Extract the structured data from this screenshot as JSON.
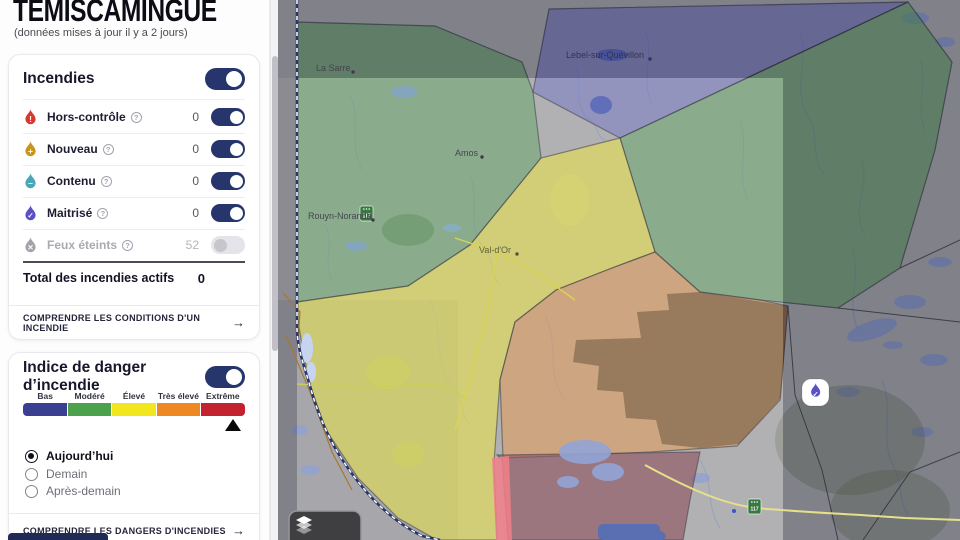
{
  "header": {
    "title": "TÉMISCAMINGUE",
    "subtitle": "(données mises à jour il y a 2 jours)"
  },
  "fires": {
    "section_title": "Incendies",
    "rows": [
      {
        "label": "Hors-contrôle",
        "count": "0",
        "color": "#d6392f",
        "symbol": "!",
        "toggle": "on"
      },
      {
        "label": "Nouveau",
        "count": "0",
        "color": "#c9941c",
        "symbol": "+",
        "toggle": "on"
      },
      {
        "label": "Contenu",
        "count": "0",
        "color": "#49a8b8",
        "symbol": "–",
        "toggle": "on"
      },
      {
        "label": "Maitrisé",
        "count": "0",
        "color": "#5b50c5",
        "symbol": "✓",
        "toggle": "on"
      },
      {
        "label": "Feux éteints",
        "count": "52",
        "color": "#a2a2a8",
        "symbol": "✕",
        "toggle": "off"
      }
    ],
    "info_icon": "?",
    "total_label": "Total des incendies actifs",
    "total_value": "0",
    "link": "COMPRENDRE LES CONDITIONS D'UN INCENDIE",
    "link_arrow": "→"
  },
  "danger": {
    "section_title": "Indice de danger d’incendie",
    "levels": [
      {
        "label": "Bas",
        "color": "#3b3f92"
      },
      {
        "label": "Modéré",
        "color": "#4ca24c"
      },
      {
        "label": "Élevé",
        "color": "#f2e71e"
      },
      {
        "label": "Très élevé",
        "color": "#ed8822"
      },
      {
        "label": "Extrême",
        "color": "#c2232e"
      }
    ],
    "current_level": "Extrême",
    "options": [
      {
        "label": "Aujourd’hui"
      },
      {
        "label": "Demain"
      },
      {
        "label": "Après-demain"
      }
    ],
    "link": "COMPRENDRE LES DANGERS D'INCENDIES",
    "link_arrow": "→"
  },
  "map": {
    "labels": {
      "la_sarre": "La Sarre",
      "amos": "Amos",
      "rouyn": "Rouyn-Noranda",
      "val_dor": "Val-d'Or",
      "lebel": "Lebel-sur-Quévillon"
    },
    "route_shield": "117",
    "marker_color": "#5b50c5",
    "marker_symbol": "✓"
  }
}
